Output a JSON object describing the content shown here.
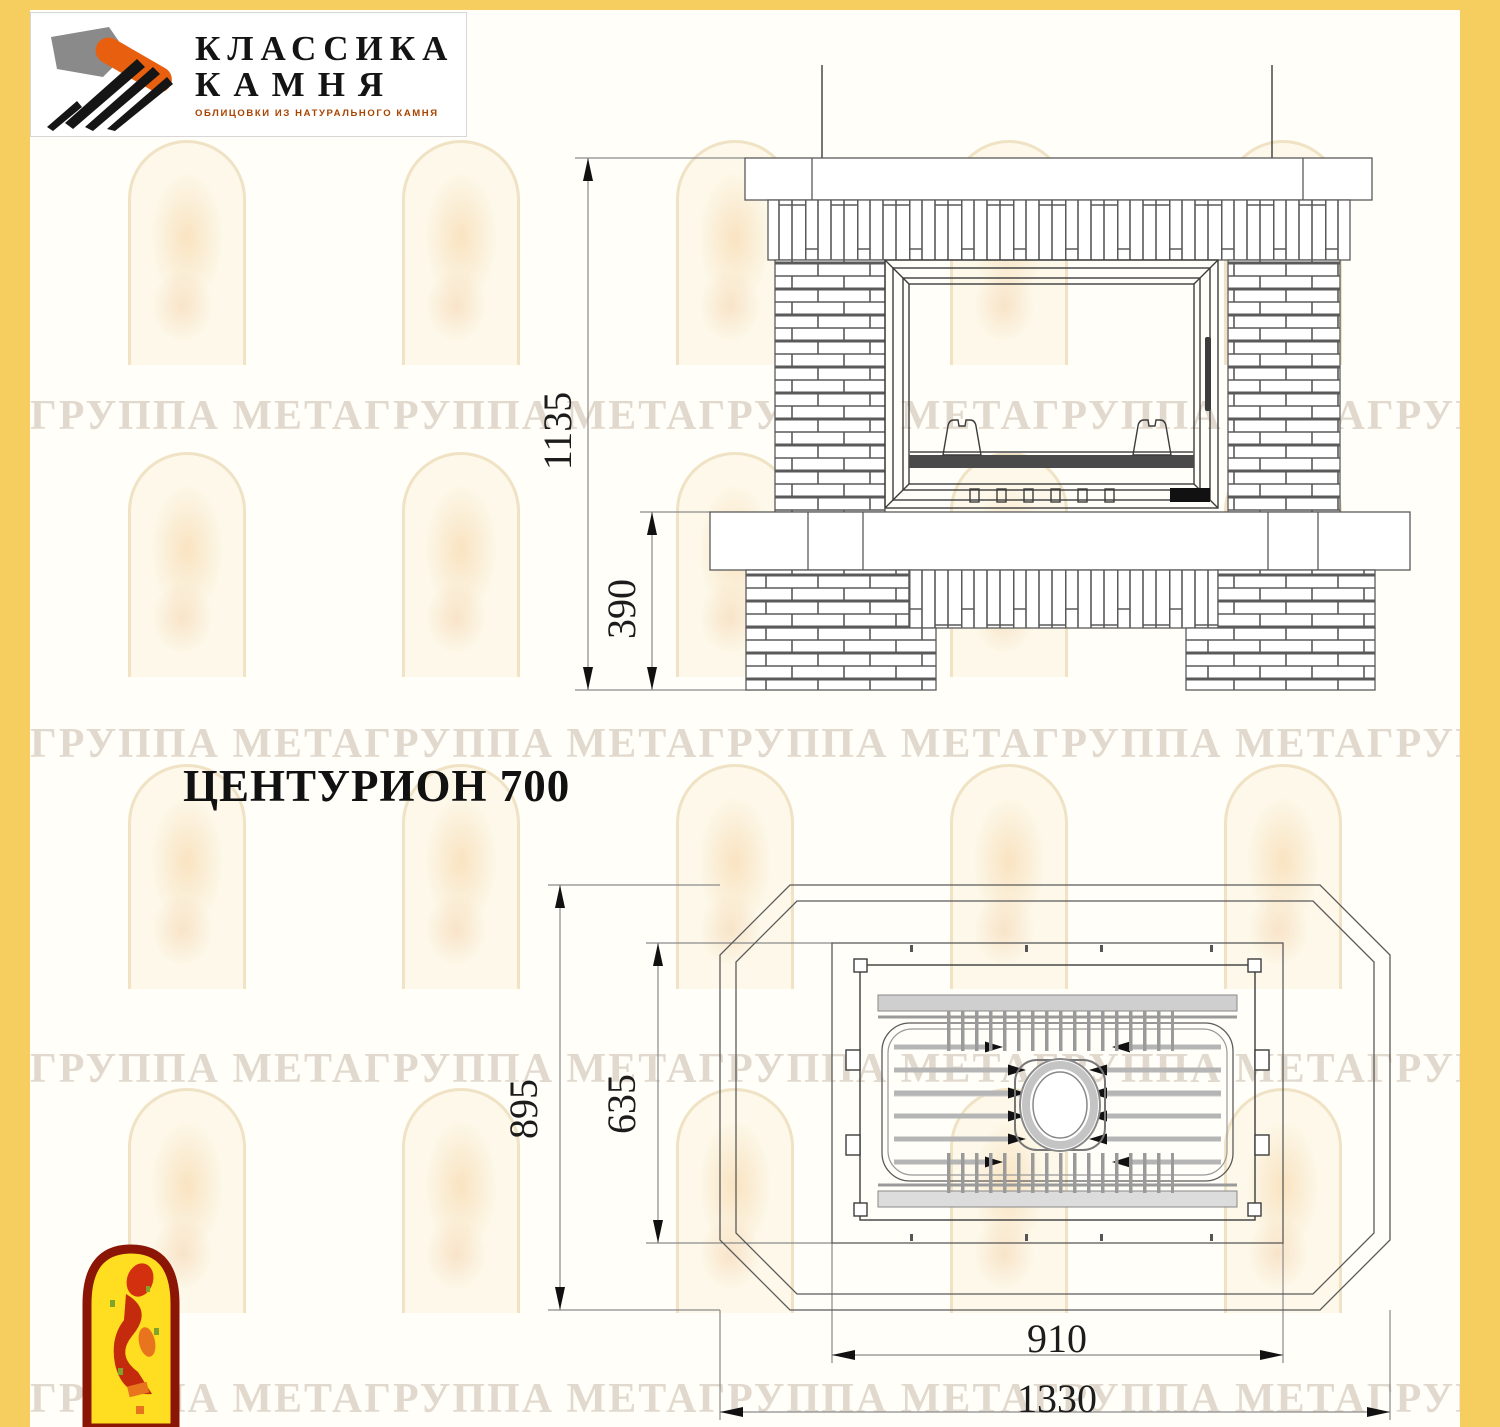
{
  "window": {
    "width": 1500,
    "height": 1427
  },
  "colors": {
    "frame-yellow": "#F6CD5F",
    "content-bg": "#FFFEF8",
    "logo-orange": "#E8600F",
    "tagline-orange": "#A84300",
    "arch-red": "#8B1606",
    "arch-yellow": "#FFDD20"
  },
  "brand_logo": {
    "title_line1": "КЛАССИКА",
    "title_line2": "КАМНЯ",
    "tagline": "ОБЛИЦОВКИ ИЗ НАТУРАЛЬНОГО КАМНЯ"
  },
  "title": "ЦЕНТУРИОН 700",
  "watermark": {
    "text": "ГРУППА МЕТАГРУППА МЕТАГРУППА МЕТАГРУППА МЕТАГРУППА МЕТА"
  },
  "front_view": {
    "label": "front elevation",
    "dim_total_height": "1135",
    "dim_base_height": "390"
  },
  "plan_view": {
    "label": "top plan",
    "dim_total_depth": "895",
    "dim_insert_depth": "635",
    "dim_insert_width": "910",
    "dim_total_width": "1330"
  }
}
